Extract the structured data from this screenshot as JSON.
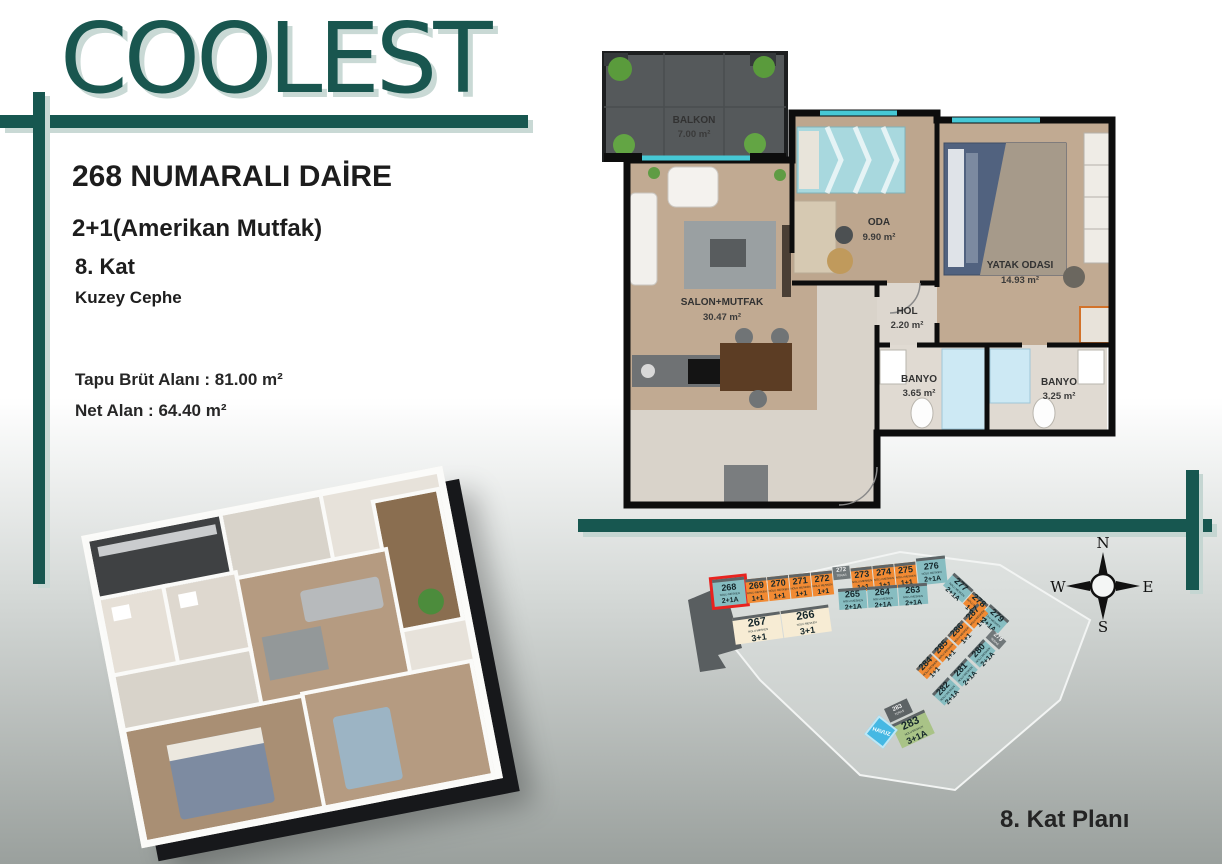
{
  "brand": {
    "logo": "COOLEST"
  },
  "apartment": {
    "title": "268 NUMARALI DAİRE",
    "type": "2+1(Amerikan Mutfak)",
    "floor": "8. Kat",
    "facade": "Kuzey Cephe",
    "gross_area_label": "Tapu Brüt Alanı :",
    "gross_area_value": "81.00 m²",
    "net_area_label": "Net Alan :",
    "net_area_value": "64.40 m²"
  },
  "floorplan": {
    "rooms": [
      {
        "name": "BALKON",
        "area": "7.00 m²"
      },
      {
        "name": "SALON+MUTFAK",
        "area": "30.47 m²"
      },
      {
        "name": "ODA",
        "area": "9.90 m²"
      },
      {
        "name": "YATAK ODASI",
        "area": "14.93 m²"
      },
      {
        "name": "HOL",
        "area": "2.20 m²"
      },
      {
        "name": "BANYO",
        "area": "3.65 m²"
      },
      {
        "name": "BANYO",
        "area": "3.25 m²"
      }
    ]
  },
  "siteplan": {
    "caption": "8. Kat Planı",
    "unit_sub": "NOLU MESKEN",
    "pool_label": "HAVUZ",
    "compass": {
      "n": "N",
      "s": "S",
      "e": "E",
      "w": "W"
    },
    "units": [
      {
        "number": "268",
        "type": "2+1A"
      },
      {
        "number": "269",
        "type": "1+1"
      },
      {
        "number": "270",
        "type": "1+1"
      },
      {
        "number": "271",
        "type": "1+1"
      },
      {
        "number": "272",
        "type": "1+1"
      },
      {
        "number": "273",
        "type": "1+1"
      },
      {
        "number": "274",
        "type": "1+1"
      },
      {
        "number": "275",
        "type": "1+1"
      },
      {
        "number": "276",
        "type": "2+1A"
      },
      {
        "number": "265",
        "type": "2+1A"
      },
      {
        "number": "264",
        "type": "2+1A"
      },
      {
        "number": "263",
        "type": "2+1A"
      },
      {
        "number": "267",
        "type": "3+1"
      },
      {
        "number": "266",
        "type": "3+1"
      },
      {
        "number": "277",
        "type": "2+1A"
      },
      {
        "number": "278",
        "type": "1+1"
      },
      {
        "number": "279",
        "type": "2+1A"
      },
      {
        "number": "287",
        "type": "1+1"
      },
      {
        "number": "286",
        "type": "1+1"
      },
      {
        "number": "285",
        "type": "1+1"
      },
      {
        "number": "284",
        "type": "1+1"
      },
      {
        "number": "280",
        "type": "2+1A"
      },
      {
        "number": "281",
        "type": "2+1A"
      },
      {
        "number": "282",
        "type": "2+1A"
      },
      {
        "number": "283",
        "type": "3+1A"
      }
    ],
    "teras_units": [
      {
        "number": "272",
        "label": "TERAS"
      },
      {
        "number": "279",
        "label": "TERAS"
      },
      {
        "number": "283",
        "label": "TERAS"
      }
    ]
  },
  "colors": {
    "brand_teal": "#175750",
    "bar_shadow": "#c9d9d5",
    "unit_teal": "#87bdc1",
    "unit_orange": "#f18a33",
    "unit_beige": "#f7ecd4",
    "unit_green": "#a9c387",
    "unit_gray": "#71787a",
    "highlight_red": "#e8231f",
    "pool_blue": "#45b8e3",
    "window_cyan": "#46c8d5"
  }
}
